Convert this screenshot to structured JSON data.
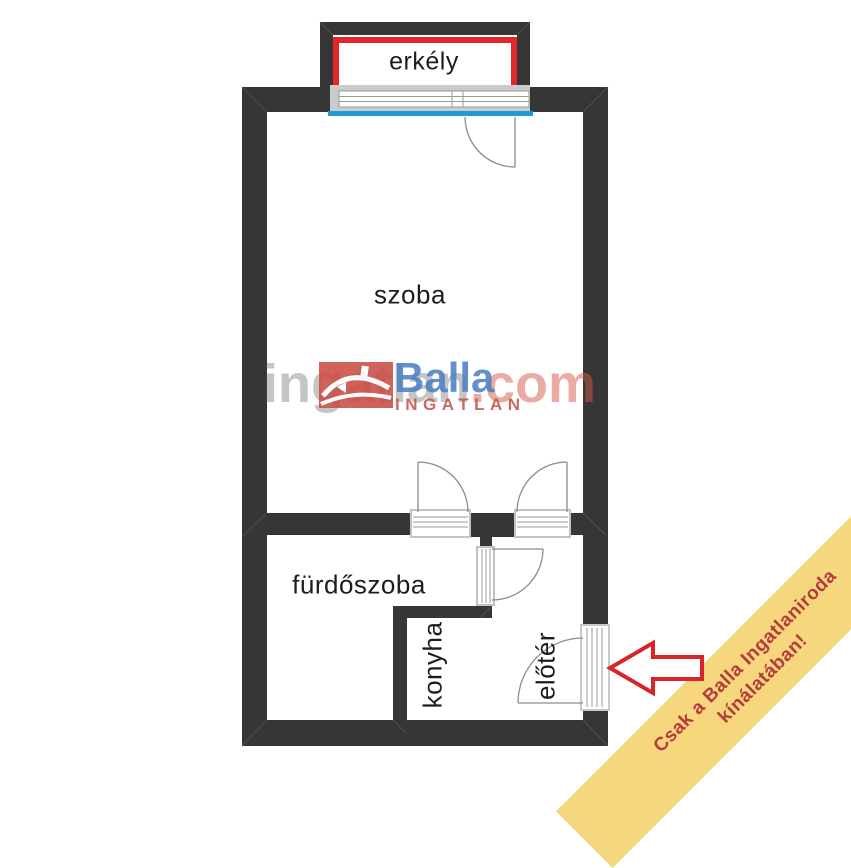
{
  "floorplan": {
    "rooms": {
      "erkely": {
        "label": "erkély"
      },
      "szoba": {
        "label": "szoba"
      },
      "furdoszoba": {
        "label": "fürdőszoba"
      },
      "konyha": {
        "label": "konyha"
      },
      "eloter": {
        "label": "előtér"
      }
    },
    "colors": {
      "wall": "#363636",
      "balcony_outline": "#e4262c",
      "window_sill_blue": "#1e9ad5",
      "door_line": "#8c8c8c",
      "frame_border": "#c2c2c2"
    }
  },
  "watermark": {
    "site_name_gray": "ingatlan",
    "site_name_red": ".com",
    "logo_brand": "Balla",
    "logo_subtitle": "INGATLAN",
    "colors": {
      "logo_square": "#ca4b44",
      "brand_blue": "#4c7fc3",
      "brand_red": "#c4534d"
    }
  },
  "promo_ribbon": {
    "line1": "Csak a Balla Ingatlaniroda",
    "line2": "kínálatában!",
    "colors": {
      "background": "#f6d77d",
      "text": "#b43c3c",
      "arrow_outline": "#d8242b"
    }
  }
}
